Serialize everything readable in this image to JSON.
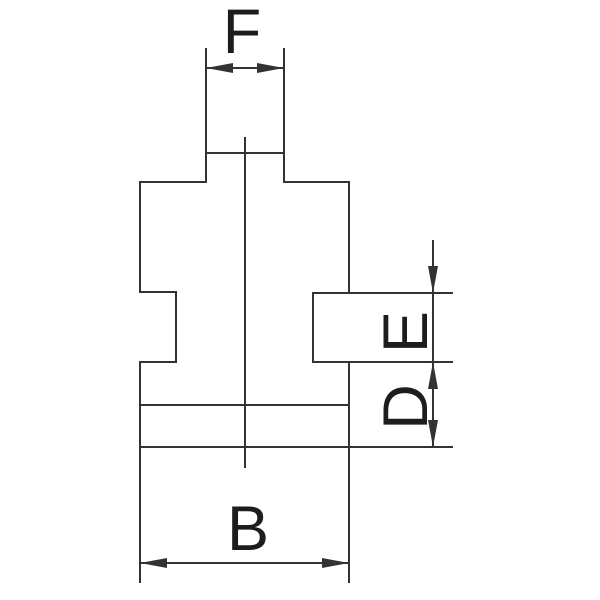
{
  "figure": {
    "kind": "technical-dimension-drawing",
    "subject": "stepped jaw profile cross-section",
    "background_color": "#ffffff",
    "line_color": "#333333",
    "text_color": "#1d1d1d"
  },
  "labels": {
    "top_width": "F",
    "right_tab_height": "E",
    "right_lower_height": "D",
    "bottom_width": "B"
  }
}
